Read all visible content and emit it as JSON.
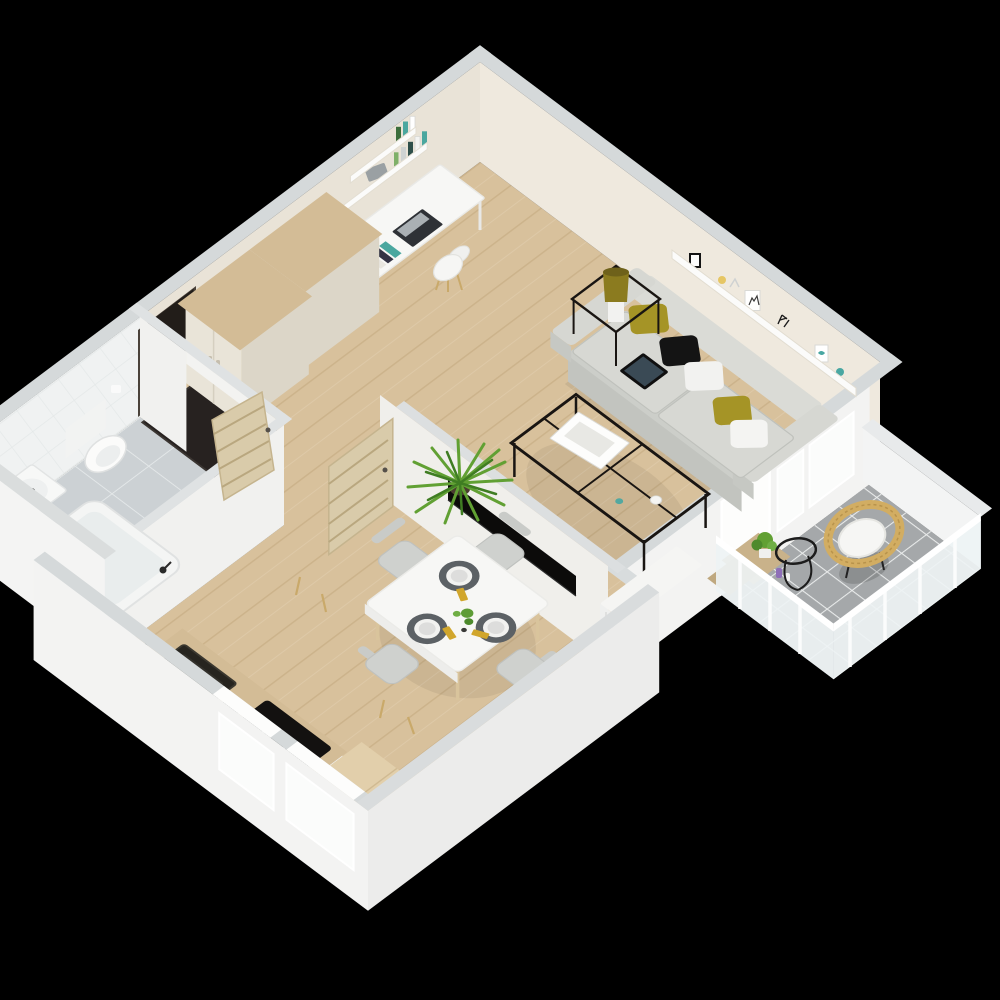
{
  "scene": {
    "kind": "isometric-3d-floor-plan-render",
    "background": "#000000",
    "rooms": [
      {
        "name": "living-room",
        "items": [
          "sofa",
          "throw-pillow-olive",
          "throw-pillow-black",
          "throw-pillow-white",
          "tablet",
          "coffee-table",
          "magazines",
          "side-table",
          "table-lamp",
          "wall-shelf",
          "picture-frames",
          "tv",
          "radiator",
          "potted-palm"
        ]
      },
      {
        "name": "study-corner",
        "items": [
          "desk",
          "laptop",
          "desk-chair",
          "wall-shelves",
          "books"
        ]
      },
      {
        "name": "hallway",
        "items": [
          "entrance-door",
          "doormat",
          "wardrobe",
          "wardrobe"
        ]
      },
      {
        "name": "bathroom",
        "items": [
          "toilet",
          "toilet-paper-holder",
          "bathtub",
          "washbasin",
          "interior-door",
          "tiled-wall"
        ]
      },
      {
        "name": "kitchen",
        "items": [
          "counter",
          "kitchen-sink",
          "faucet",
          "kettle",
          "cooktop",
          "pot",
          "island-cabinet",
          "window"
        ]
      },
      {
        "name": "dining-area",
        "items": [
          "dining-table",
          "dining-chair",
          "dining-chair",
          "dining-chair",
          "dining-chair",
          "place-setting",
          "place-setting",
          "place-setting",
          "centerpiece",
          "interior-door",
          "window"
        ]
      },
      {
        "name": "balcony",
        "items": [
          "rattan-chair",
          "wire-side-table",
          "plant-shelf",
          "potted-plant",
          "candles",
          "glass-balustrade",
          "parapet"
        ]
      }
    ]
  },
  "palette": {
    "bg": "#000000",
    "wall_top": "#d5d9da",
    "wall_white": "#f3f3f2",
    "wall_cream": "#efe9de",
    "wall_cream_dark": "#e9e3d7",
    "partition_face": "#f0efeb",
    "wood_floor": "#d8c19c",
    "wood_plank_line": "#c2a87e",
    "bath_tile": "#ccd1d4",
    "bath_tile_line": "#e3e7e8",
    "balcony_tile": "#a5a8aa",
    "balcony_grout": "#e9ebeb",
    "door_dark": "#221d19",
    "door_wood": "#d9cbaa",
    "wardrobe_front": "#e9e4d8",
    "wardrobe_side": "#dcd6c8",
    "wood_top": "#d3bc96",
    "sofa": "#cccec9",
    "sofa_light": "#dadbd6",
    "pillow_olive": "#a59426",
    "pillow_black": "#141414",
    "metal_black": "#191512",
    "lamp_olive": "#8b7b1f",
    "plant_green": "#61a033",
    "plant_green_dark": "#3f7d22",
    "rattan": "#d2ad62",
    "napkin_yellow": "#d1a62c",
    "placemat": "#5c6165",
    "tv_black": "#0c0b0a",
    "mat_dark": "#272220",
    "glass": "#eef3f4",
    "white": "#f7f7f6"
  }
}
